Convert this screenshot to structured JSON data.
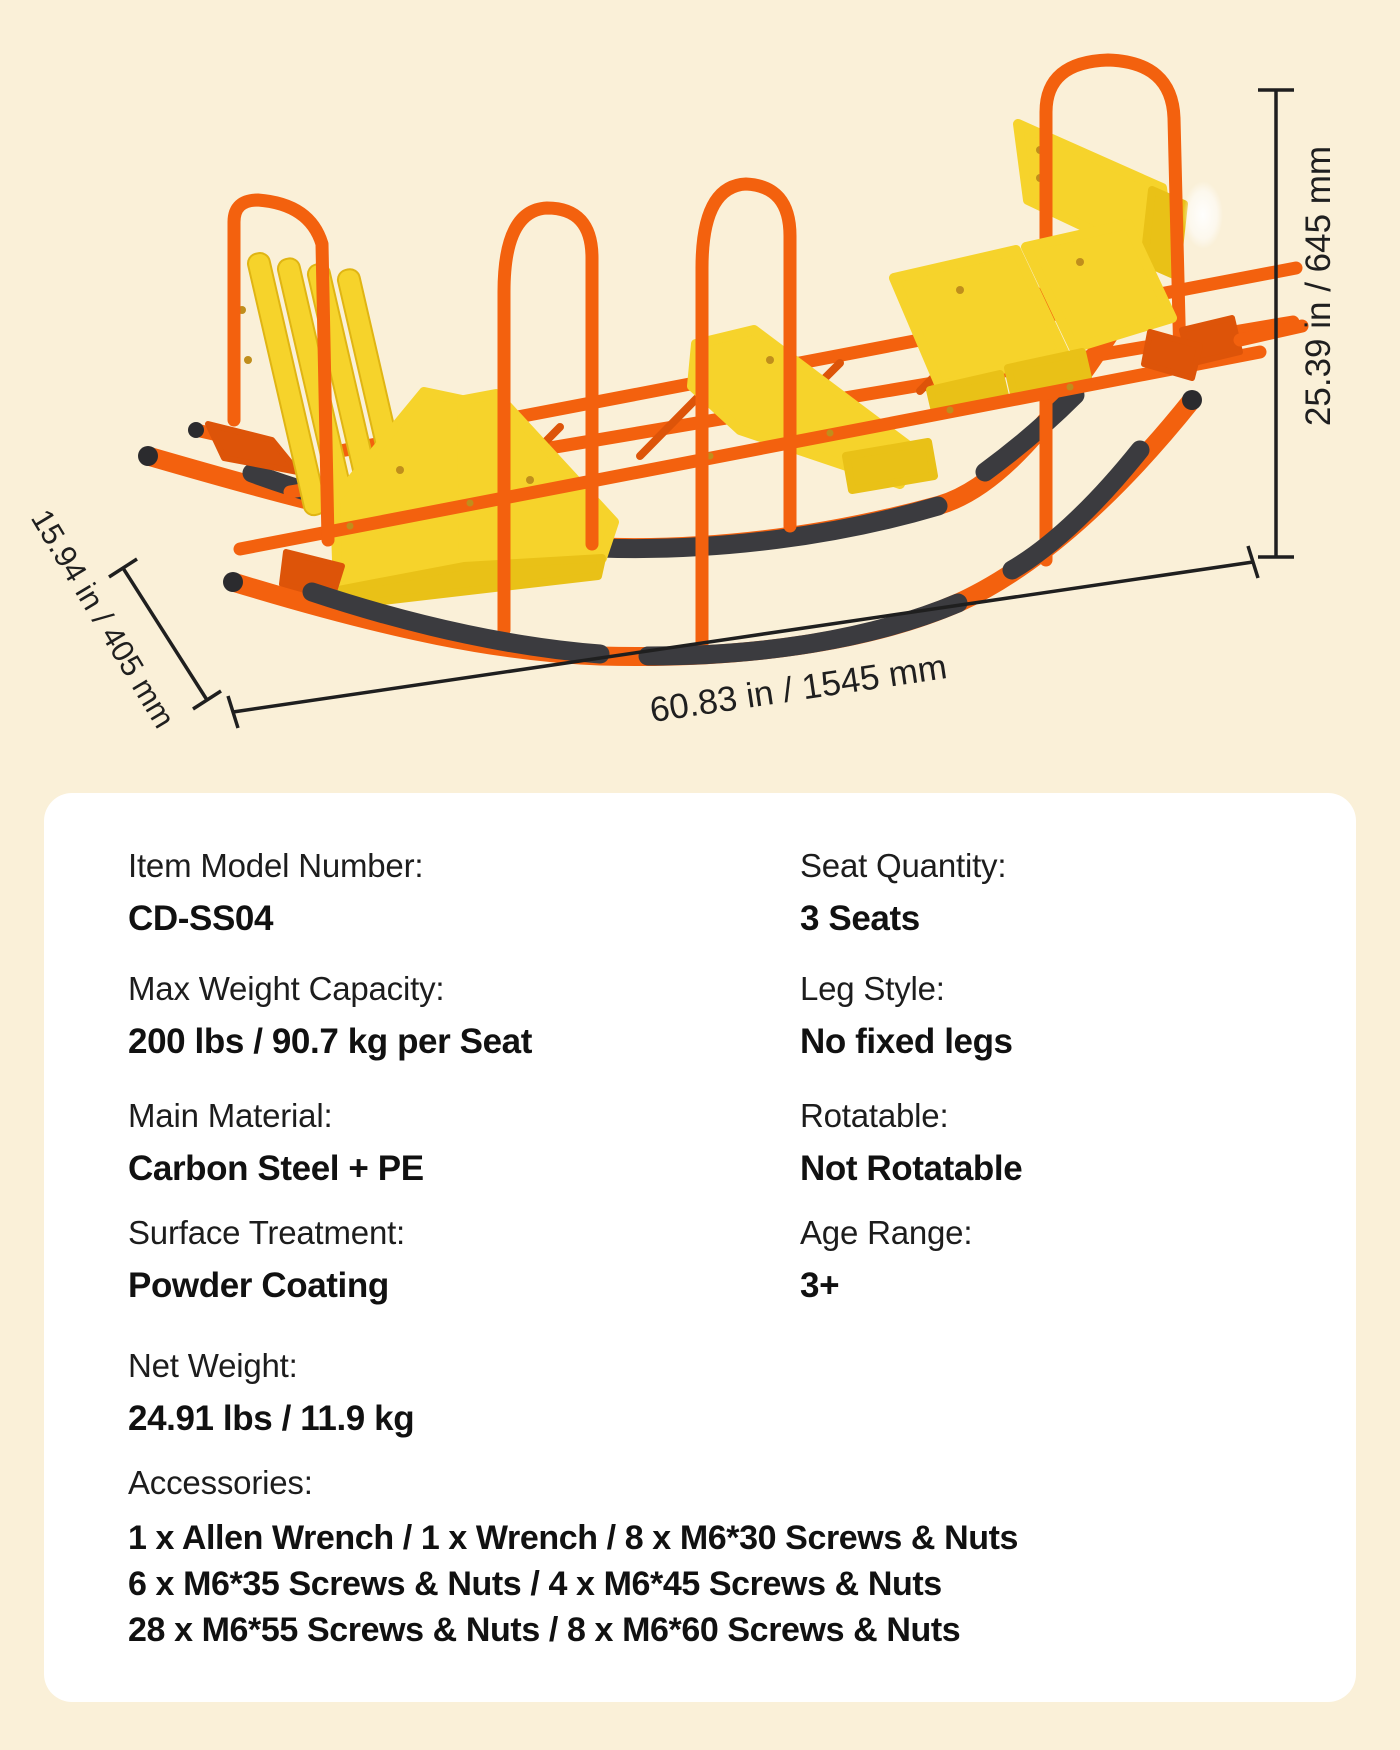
{
  "illustration": {
    "dimension_height": "25.39 in / 645 mm",
    "dimension_length": "60.83 in / 1545 mm",
    "dimension_width": "15.94 in / 405 mm",
    "colors": {
      "background_cream": "#FAF0D8",
      "frame_orange": "#F3610E",
      "seat_yellow": "#F6D32B",
      "rocker_black": "#3B3B3F",
      "dimension_line": "#1F1F1F",
      "card_white": "#FFFFFF",
      "text_ink": "#1B1B1B"
    }
  },
  "specs": {
    "rows": [
      {
        "left": {
          "label": "Item Model Number:",
          "value": "CD-SS04"
        },
        "right": {
          "label": "Seat Quantity:",
          "value": "3 Seats"
        }
      },
      {
        "left": {
          "label": "Max Weight Capacity:",
          "value": "200 lbs / 90.7 kg per Seat"
        },
        "right": {
          "label": "Leg Style:",
          "value": "No fixed legs"
        }
      },
      {
        "left": {
          "label": "Main Material:",
          "value": "Carbon Steel + PE"
        },
        "right": {
          "label": "Rotatable:",
          "value": "Not Rotatable"
        }
      },
      {
        "left": {
          "label": "Surface Treatment:",
          "value": "Powder Coating"
        },
        "right": {
          "label": "Age Range:",
          "value": "3+"
        }
      }
    ],
    "net_weight": {
      "label": "Net Weight:",
      "value": "24.91 lbs / 11.9 kg"
    },
    "accessories": {
      "label": "Accessories:",
      "lines": [
        "1 x Allen Wrench / 1 x Wrench / 8 x M6*30 Screws & Nuts",
        "6 x M6*35 Screws & Nuts / 4 x M6*45 Screws & Nuts",
        "28 x M6*55 Screws & Nuts / 8 x M6*60 Screws & Nuts"
      ]
    }
  }
}
